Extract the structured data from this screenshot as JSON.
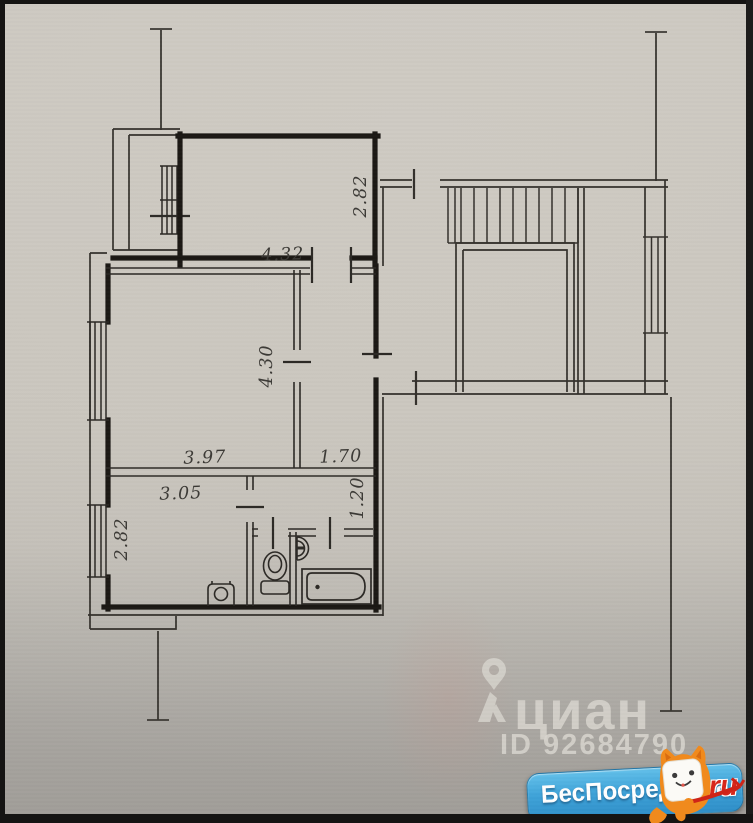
{
  "plan": {
    "dimensions": {
      "bedroom_height_m": "2.82",
      "living_width_m": "4.32",
      "living_depth_m": "4.30",
      "living_bottom_width_m": "3.97",
      "hall_width_m": "1.70",
      "kitchen_width_m": "3.05",
      "corridor_depth_m": "1.20",
      "kitchen_depth_m": "2.82"
    },
    "fixture_icons": [
      "staircase-icon",
      "bathtub-icon",
      "toilet-icon",
      "sink-icon",
      "stove-icon",
      "window-icon",
      "door-tick-icon"
    ]
  },
  "watermark": {
    "brand": "циан",
    "listing_id": "ID 92684790",
    "logo_icon": "cian-pin-person-icon"
  },
  "badge": {
    "site_name": "БесПосредника",
    "domain_suffix": ".ru",
    "mascot_icon": "orange-cat-mascot-icon",
    "background_color": "#3fa3d9",
    "suffix_color": "#d8261a"
  }
}
